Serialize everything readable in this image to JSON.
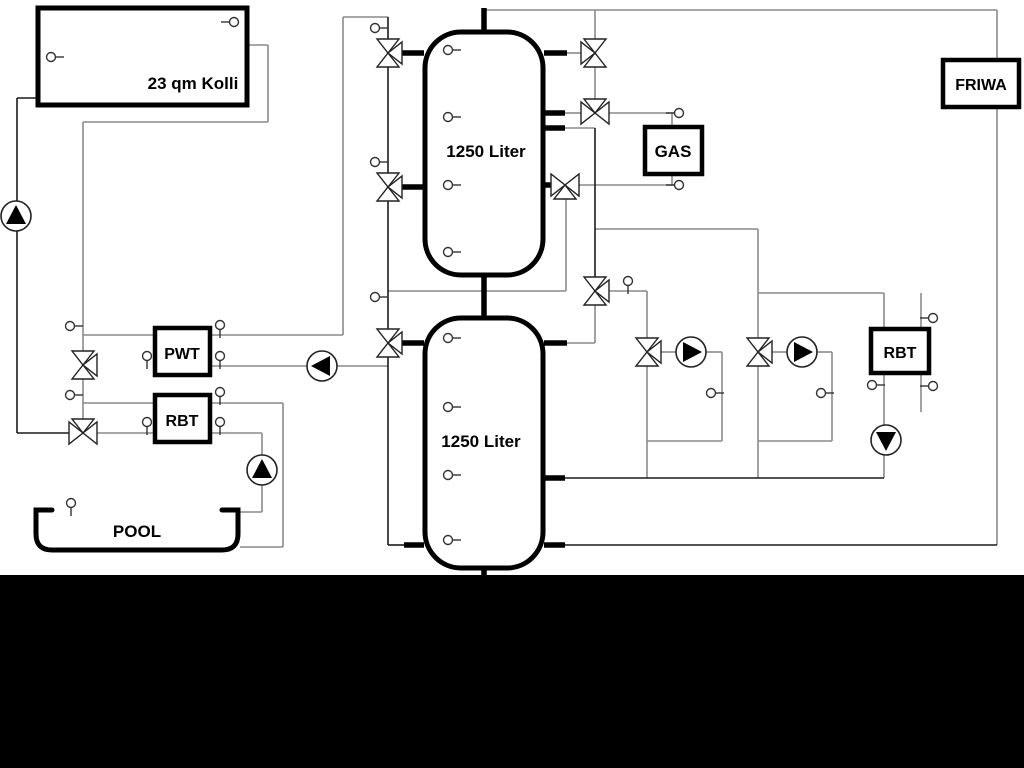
{
  "labels": {
    "collector": "23 qm Kolli",
    "tank_top": "1250 Liter",
    "tank_bottom": "1250 Liter",
    "gas": "GAS",
    "friwa": "FRIWA",
    "pwt": "PWT",
    "rbt_left": "RBT",
    "rbt_right": "RBT",
    "pool": "POOL"
  },
  "colors": {
    "pipe_gray": "#8a8a8a",
    "pipe_dark": "#1a1a1a",
    "component_stroke": "#000000",
    "background": "#ffffff",
    "bottom_mask": "#000000"
  },
  "components": {
    "pumps": [
      {
        "id": "collector-pump",
        "direction": "up"
      },
      {
        "id": "solar-secondary-pump",
        "direction": "left"
      },
      {
        "id": "pool-pump",
        "direction": "up"
      },
      {
        "id": "heating-circuit-1-pump",
        "direction": "right"
      },
      {
        "id": "heating-circuit-2-pump",
        "direction": "right"
      },
      {
        "id": "rbt-right-pump",
        "direction": "down"
      }
    ],
    "three_way_valve_count": 11,
    "temperature_sensor_count": 30,
    "storage_tanks": 2,
    "heat_exchangers": [
      "PWT",
      "RBT",
      "RBT"
    ],
    "boiler": "GAS",
    "fresh_water_station": "FRIWA"
  }
}
